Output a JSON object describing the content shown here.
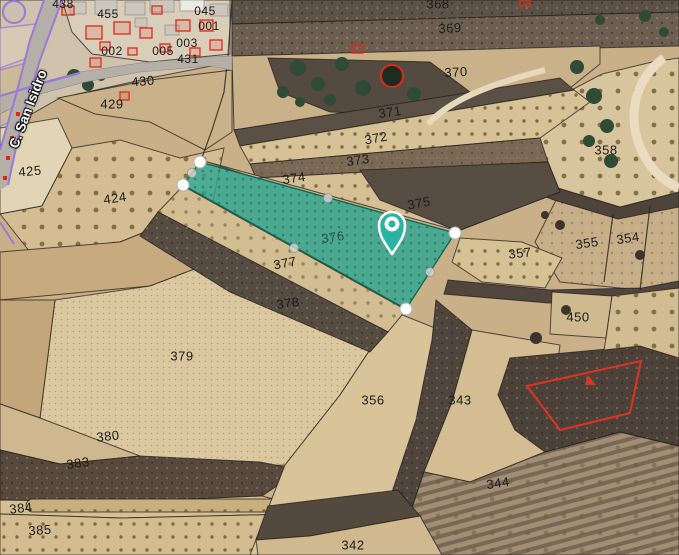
{
  "map": {
    "street_label": "C. San Isidro",
    "selected_parcel": {
      "number": "376",
      "fill_color": "#2cb4a3",
      "vertex_count": 4
    },
    "pin_color": "#2cb4a3",
    "urban_boundary_color": "#dc2a1a",
    "road_edge_color": "#9a79d8",
    "cadastral_line_color": "#241f1a",
    "labels": [
      {
        "text": "438",
        "x": 63,
        "y": 4,
        "rot": 0,
        "cls": "small"
      },
      {
        "text": "455",
        "x": 108,
        "y": 14,
        "rot": 0,
        "cls": "small"
      },
      {
        "text": "045",
        "x": 205,
        "y": 11,
        "rot": 0,
        "cls": "small"
      },
      {
        "text": "001",
        "x": 209,
        "y": 26,
        "rot": 0,
        "cls": "small"
      },
      {
        "text": "002",
        "x": 112,
        "y": 51,
        "rot": 0,
        "cls": "small"
      },
      {
        "text": "003",
        "x": 187,
        "y": 43,
        "rot": 0,
        "cls": "small"
      },
      {
        "text": "005",
        "x": 163,
        "y": 51,
        "rot": 0,
        "cls": "small"
      },
      {
        "text": "431",
        "x": 188,
        "y": 59,
        "rot": 0,
        "cls": "small"
      },
      {
        "text": "430",
        "x": 143,
        "y": 81,
        "rot": -5
      },
      {
        "text": "429",
        "x": 112,
        "y": 104,
        "rot": 0
      },
      {
        "text": "425",
        "x": 30,
        "y": 171,
        "rot": -5
      },
      {
        "text": "424",
        "x": 115,
        "y": 198,
        "rot": -8
      },
      {
        "text": "368",
        "x": 438,
        "y": 4,
        "rot": 0
      },
      {
        "text": "369",
        "x": 450,
        "y": 28,
        "rot": -3
      },
      {
        "text": "370",
        "x": 456,
        "y": 72,
        "rot": -3
      },
      {
        "text": "371",
        "x": 390,
        "y": 112,
        "rot": -8
      },
      {
        "text": "372",
        "x": 376,
        "y": 138,
        "rot": -10
      },
      {
        "text": "373",
        "x": 358,
        "y": 160,
        "rot": -8
      },
      {
        "text": "374",
        "x": 294,
        "y": 178,
        "rot": -8
      },
      {
        "text": "375",
        "x": 419,
        "y": 203,
        "rot": -10
      },
      {
        "text": "376",
        "x": 333,
        "y": 237,
        "rot": -8,
        "cls": "sel"
      },
      {
        "text": "377",
        "x": 285,
        "y": 263,
        "rot": -10
      },
      {
        "text": "378",
        "x": 288,
        "y": 303,
        "rot": -8
      },
      {
        "text": "379",
        "x": 182,
        "y": 356,
        "rot": 0
      },
      {
        "text": "380",
        "x": 108,
        "y": 436,
        "rot": -6
      },
      {
        "text": "383",
        "x": 78,
        "y": 463,
        "rot": -8
      },
      {
        "text": "384",
        "x": 21,
        "y": 508,
        "rot": -6
      },
      {
        "text": "385",
        "x": 40,
        "y": 530,
        "rot": -4
      },
      {
        "text": "356",
        "x": 373,
        "y": 400,
        "rot": 0
      },
      {
        "text": "343",
        "x": 460,
        "y": 400,
        "rot": 0
      },
      {
        "text": "344",
        "x": 498,
        "y": 483,
        "rot": -8
      },
      {
        "text": "342",
        "x": 353,
        "y": 545,
        "rot": 0
      },
      {
        "text": "357",
        "x": 520,
        "y": 253,
        "rot": -6
      },
      {
        "text": "358",
        "x": 606,
        "y": 150,
        "rot": 0
      },
      {
        "text": "355",
        "x": 587,
        "y": 243,
        "rot": -8
      },
      {
        "text": "354",
        "x": 628,
        "y": 238,
        "rot": -8
      },
      {
        "text": "450",
        "x": 578,
        "y": 317,
        "rot": 0
      }
    ]
  }
}
